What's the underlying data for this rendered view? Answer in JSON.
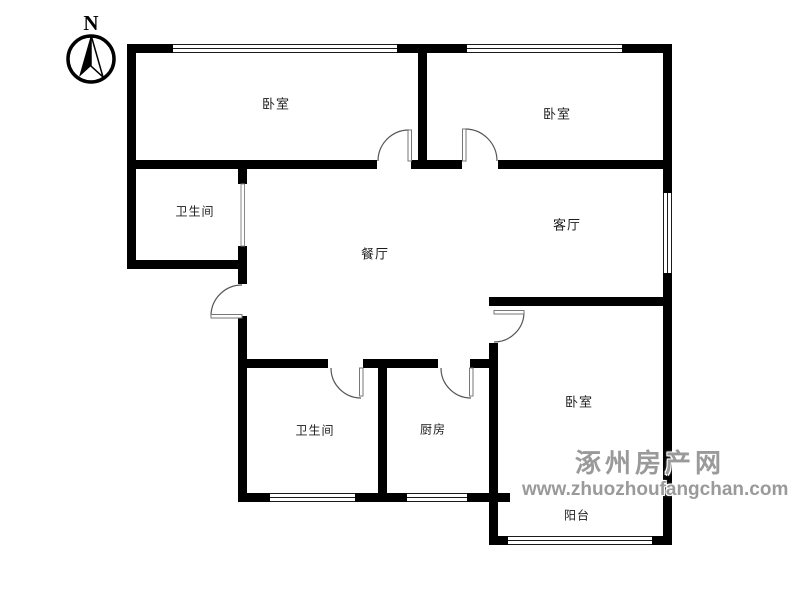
{
  "compass": {
    "label": "N"
  },
  "rooms": {
    "bedroom_top_left": "卧室",
    "bedroom_top_right": "卧室",
    "bathroom_upper": "卫生间",
    "dining": "餐厅",
    "living": "客厅",
    "bathroom_lower": "卫生间",
    "kitchen": "厨房",
    "bedroom_bottom": "卧室",
    "balcony": "阳台"
  },
  "watermark": {
    "site_name": "涿州房产网",
    "site_url": "www.zhuozhoufangchan.com",
    "color": "#9a9a9a"
  },
  "colors": {
    "wall": "#000000",
    "background": "#ffffff",
    "door_line": "#666666"
  }
}
